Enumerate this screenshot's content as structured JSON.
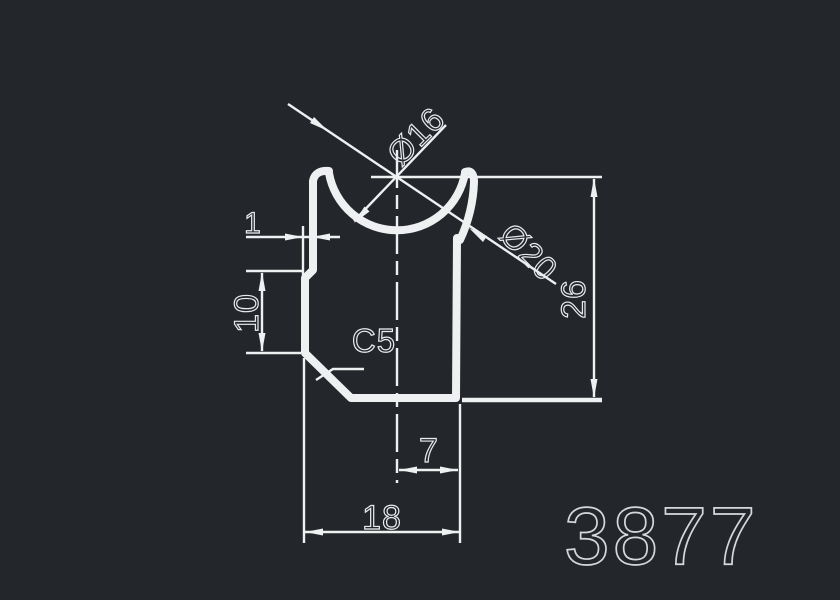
{
  "drawing": {
    "part_number": "3877",
    "dimensions": {
      "dia_inner": "Ø16",
      "dia_outer": "Ø20",
      "overall_height": "26",
      "step": "1",
      "left_height": "10",
      "chamfer": "C5",
      "half_width": "7",
      "overall_width": "18"
    }
  },
  "colors": {
    "background": "#23272b",
    "line": "#eef0f2",
    "text": "#e8ebee",
    "part_number": "#d5d8db"
  }
}
